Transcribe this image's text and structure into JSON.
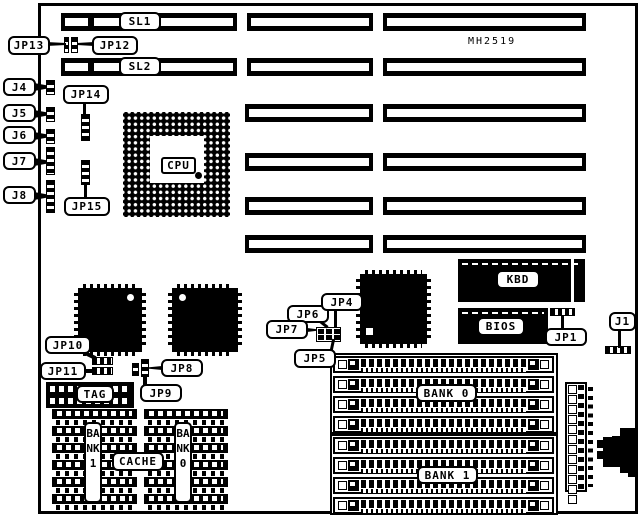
{
  "board": {
    "part_number": "MH2519"
  },
  "slots": {
    "sl1": "SL1",
    "sl2": "SL2"
  },
  "chips": {
    "cpu": "CPU",
    "kbd": "KBD",
    "bios": "BIOS"
  },
  "callouts": {
    "jp13": "JP13",
    "jp12": "JP12",
    "j4": "J4",
    "j5": "J5",
    "j6": "J6",
    "j7": "J7",
    "j8": "J8",
    "jp14": "JP14",
    "jp15": "JP15",
    "jp10": "JP10",
    "jp11": "JP11",
    "jp8": "JP8",
    "jp9": "JP9",
    "jp6": "JP6",
    "jp4": "JP4",
    "jp7": "JP7",
    "jp5": "JP5",
    "jp1": "JP1",
    "j1": "J1"
  },
  "memory": {
    "tag": "TAG",
    "cache": "CACHE",
    "bank1_dip": "BANK1",
    "bank0_dip": "BANK0",
    "bank0_simm": "BANK 0",
    "bank1_simm": "BANK 1"
  },
  "colors": {
    "ink": "#000000",
    "paper": "#ffffff"
  }
}
